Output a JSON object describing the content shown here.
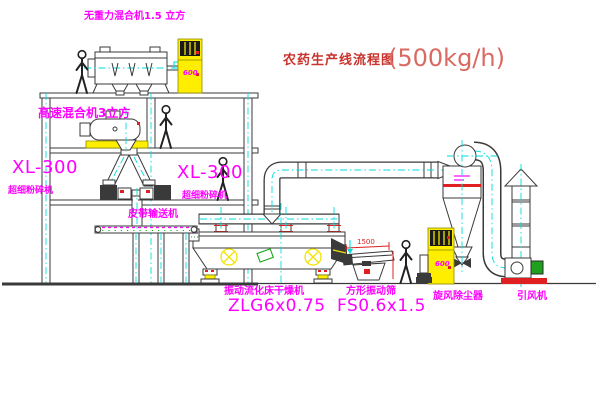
{
  "title": {
    "text": "农药生产线流程图",
    "capacity": "(500kg/h)"
  },
  "equipment_labels": {
    "gravity_mixer": "无重力混合机1.5 立方",
    "high_speed_mixer": "高速混合机3立方",
    "mill_left": {
      "model": "XL-300",
      "name": "超细粉碎机"
    },
    "mill_right": {
      "model": "XL-300",
      "name": "超细粉碎机"
    },
    "belt_conveyor": "皮带输送机",
    "fluid_bed_dryer": {
      "name": "振动流化床干燥机",
      "model": "ZLG6x0.75"
    },
    "vibrating_sieve": {
      "name": "方形振动筛",
      "model": "FS0.6x1.5"
    },
    "cyclone": "旋风除尘器",
    "induced_draft_fan": "引风机"
  },
  "dimensions": {
    "sieve_length": "1500"
  },
  "markings": {
    "control_cabinet_top": "600",
    "control_cabinet_right": "600"
  },
  "colors": {
    "bg": "#ffffff",
    "label-magenta": "#ff00ff",
    "title-red": "#c8342e",
    "capacity-red": "#d96a62",
    "dim-red": "#e02020",
    "line-ink": "#3a3a3a",
    "centerline-cyan": "#00dede",
    "machine-yellow": "#f2e400",
    "cabinet-yellow": "#ffee00",
    "accent-green": "#18a818"
  }
}
